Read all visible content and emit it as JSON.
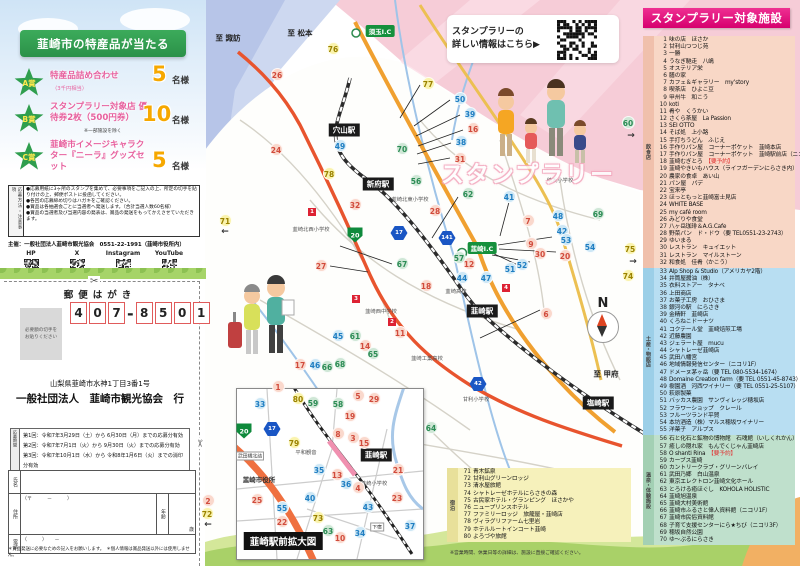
{
  "prize_panel": {
    "ribbon": "韮崎市の特産品が当たる",
    "prizes": [
      {
        "badge": "A賞",
        "title": "特産品詰め合わせ",
        "note": "（3千円相当）",
        "count": "5",
        "unit": "名様"
      },
      {
        "badge": "B賞",
        "title": "スタンプラリー対象店 優待券2枚（500円券）",
        "note": "※一部施設を除く",
        "count": "10",
        "unit": "名様"
      },
      {
        "badge": "C賞",
        "title": "韮崎市イメージキャラクター『ニーラ』グッズセット",
        "note": "",
        "count": "5",
        "unit": "名様"
      }
    ],
    "notes_label": "応募方法・注意事項",
    "notes": [
      "●応募用紙に3ヶ所のスタンプを集めて、必要事項をご記入の上、所定の切手を貼り付けの上、郵便ポストに投函してください。",
      "●各回の応募締め切りはハガキをご確認ください。",
      "●賞品は各抽選会ごとに当選者へ発送します。（合計当選人数60名様）",
      "●賞品の当選者及び当選内容の発表は、賞品の発送をもってかえさせていただきます。"
    ],
    "organizer": "主催：一般社団法人韮崎市観光協会　0551-22-1991（韮崎市役所内）",
    "sns": [
      "HP",
      "X",
      "Instagram",
      "YouTube"
    ]
  },
  "postcard": {
    "header": "郵便はがき",
    "postal_code": [
      "4",
      "0",
      "7",
      "8",
      "5",
      "0",
      "1"
    ],
    "stamp_note": "必要額の切手を\nお貼りください",
    "address": "山梨県韮崎市水神1丁目3番1号",
    "recipient": "一般社団法人　韮崎市観光協会　行",
    "rounds_label": "応募期間",
    "rounds": [
      "第1回：令和7年3月29日（土）から 6月30日（月）までの応募分有効",
      "第2回：令和7年7月1日（火）から 9月30日（火）までの応募分有効",
      "第3回：令和7年10月1日（水）から 令和8年1月6日（火）までの消印分有効"
    ],
    "form": {
      "name_label": "氏名",
      "address_label": "住所",
      "zip": "（〒　　　－　　　）",
      "age_label": "年齢",
      "age_unit": "歳",
      "tel_label": "電話",
      "tel_format": "（　　　）　　－"
    },
    "footnote": "＊賞品発送に必要なための記入をお願いします。　＊個人情報は賞品発送以外には使用しません。"
  },
  "map": {
    "info_banner_line1": "スタンプラリーの",
    "info_banner_line2": "詳しい情報はこちら▶",
    "deco_title": "スタンプラリー",
    "inset_title": "韮崎駅前拡大図",
    "compass": "N",
    "labels": [
      {
        "t": "至 諏訪",
        "x": 228,
        "y": 38,
        "k": "dir"
      },
      {
        "t": "至 松本",
        "x": 300,
        "y": 33,
        "k": "dir"
      },
      {
        "t": "至 甲府",
        "x": 606,
        "y": 374,
        "k": "dir"
      },
      {
        "t": "須玉I.C",
        "x": 380,
        "y": 31,
        "k": "ic"
      },
      {
        "t": "韮崎I.C",
        "x": 482,
        "y": 248,
        "k": "ic"
      },
      {
        "t": "穴山駅",
        "x": 344,
        "y": 130,
        "k": "station"
      },
      {
        "t": "新府駅",
        "x": 378,
        "y": 184,
        "k": "station"
      },
      {
        "t": "韮崎駅",
        "x": 482,
        "y": 311,
        "k": "station"
      },
      {
        "t": "塩崎駅",
        "x": 598,
        "y": 403,
        "k": "station"
      },
      {
        "t": "韮崎駅",
        "x": 376,
        "y": 455,
        "k": "station"
      },
      {
        "t": "穂坂小学校",
        "x": 560,
        "y": 180,
        "k": "school"
      },
      {
        "t": "韮崎北東小学校",
        "x": 410,
        "y": 199,
        "k": "school"
      },
      {
        "t": "韮崎北西小学校",
        "x": 311,
        "y": 229,
        "k": "school"
      },
      {
        "t": "韮崎西中学校",
        "x": 381,
        "y": 311,
        "k": "school"
      },
      {
        "t": "韮崎高校",
        "x": 456,
        "y": 291,
        "k": "school"
      },
      {
        "t": "韮崎工業高校",
        "x": 427,
        "y": 358,
        "k": "school"
      },
      {
        "t": "甘利小学校",
        "x": 476,
        "y": 399,
        "k": "school"
      },
      {
        "t": "韮崎小学校",
        "x": 374,
        "y": 483,
        "k": "school"
      },
      {
        "t": "平和観音",
        "x": 306,
        "y": 452,
        "k": "school"
      },
      {
        "t": "韮崎市役所",
        "x": 259,
        "y": 479,
        "k": "place"
      },
      {
        "t": "武田橋北詰",
        "x": 250,
        "y": 456,
        "k": "smallbox"
      },
      {
        "t": "下宿",
        "x": 377,
        "y": 527,
        "k": "smallbox"
      },
      {
        "t": "←",
        "x": 225,
        "y": 232,
        "k": "arrow"
      },
      {
        "t": "←",
        "x": 208,
        "y": 525,
        "k": "arrow"
      },
      {
        "t": "→",
        "x": 631,
        "y": 136,
        "k": "arrow"
      },
      {
        "t": "→",
        "x": 633,
        "y": 262,
        "k": "arrow"
      }
    ],
    "route_badges": [
      {
        "t": "141",
        "x": 447,
        "y": 238,
        "s": "hex"
      },
      {
        "t": "17",
        "x": 399,
        "y": 233,
        "s": "hex"
      },
      {
        "t": "42",
        "x": 478,
        "y": 384,
        "s": "hex"
      },
      {
        "t": "20",
        "x": 355,
        "y": 235,
        "s": "shield"
      },
      {
        "t": "20",
        "x": 244,
        "y": 431,
        "s": "shield"
      },
      {
        "t": "17",
        "x": 272,
        "y": 429,
        "s": "hex"
      }
    ],
    "spot_badges": [
      {
        "t": "1",
        "x": 312,
        "y": 212
      },
      {
        "t": "3",
        "x": 356,
        "y": 299
      },
      {
        "t": "2",
        "x": 392,
        "y": 322
      },
      {
        "t": "4",
        "x": 506,
        "y": 288
      }
    ],
    "markers": [
      [
        1,
        278,
        386,
        "f"
      ],
      [
        2,
        208,
        500,
        "f"
      ],
      [
        3,
        353,
        437,
        "f"
      ],
      [
        4,
        358,
        487,
        "f"
      ],
      [
        5,
        358,
        395,
        "f"
      ],
      [
        6,
        546,
        313,
        "f"
      ],
      [
        7,
        528,
        220,
        "f"
      ],
      [
        8,
        338,
        433,
        "f"
      ],
      [
        9,
        531,
        243,
        "f"
      ],
      [
        10,
        340,
        537,
        "f"
      ],
      [
        11,
        400,
        332,
        "f"
      ],
      [
        12,
        469,
        263,
        "f"
      ],
      [
        13,
        337,
        474,
        "f"
      ],
      [
        14,
        365,
        345,
        "f"
      ],
      [
        15,
        364,
        442,
        "f"
      ],
      [
        16,
        473,
        128,
        "f"
      ],
      [
        17,
        300,
        364,
        "f"
      ],
      [
        18,
        426,
        285,
        "f"
      ],
      [
        19,
        350,
        415,
        "f"
      ],
      [
        20,
        565,
        255,
        "f"
      ],
      [
        21,
        398,
        469,
        "f"
      ],
      [
        22,
        282,
        521,
        "f"
      ],
      [
        23,
        397,
        497,
        "f"
      ],
      [
        24,
        276,
        149,
        "f"
      ],
      [
        25,
        257,
        499,
        "f"
      ],
      [
        26,
        277,
        74,
        "f"
      ],
      [
        27,
        321,
        265,
        "f"
      ],
      [
        28,
        435,
        210,
        "f"
      ],
      [
        29,
        374,
        398,
        "f"
      ],
      [
        30,
        540,
        253,
        "f"
      ],
      [
        31,
        460,
        158,
        "f"
      ],
      [
        32,
        355,
        204,
        "f"
      ],
      [
        33,
        260,
        403,
        "s"
      ],
      [
        34,
        360,
        532,
        "s"
      ],
      [
        35,
        319,
        469,
        "s"
      ],
      [
        36,
        346,
        483,
        "s"
      ],
      [
        37,
        410,
        525,
        "s"
      ],
      [
        38,
        461,
        141,
        "s"
      ],
      [
        39,
        470,
        113,
        "s"
      ],
      [
        40,
        310,
        497,
        "s"
      ],
      [
        41,
        509,
        196,
        "s"
      ],
      [
        42,
        562,
        230,
        "s"
      ],
      [
        43,
        368,
        506,
        "s"
      ],
      [
        44,
        462,
        277,
        "s"
      ],
      [
        45,
        338,
        335,
        "s"
      ],
      [
        46,
        315,
        364,
        "s"
      ],
      [
        47,
        486,
        277,
        "s"
      ],
      [
        48,
        558,
        215,
        "s"
      ],
      [
        49,
        340,
        145,
        "s"
      ],
      [
        50,
        460,
        98,
        "s"
      ],
      [
        51,
        510,
        268,
        "s"
      ],
      [
        52,
        522,
        264,
        "s"
      ],
      [
        53,
        566,
        239,
        "s"
      ],
      [
        54,
        590,
        246,
        "s"
      ],
      [
        55,
        282,
        507,
        "s"
      ],
      [
        56,
        416,
        180,
        "g"
      ],
      [
        57,
        459,
        257,
        "g"
      ],
      [
        58,
        338,
        403,
        "g"
      ],
      [
        59,
        313,
        402,
        "g"
      ],
      [
        60,
        628,
        122,
        "g"
      ],
      [
        61,
        355,
        335,
        "g"
      ],
      [
        62,
        468,
        193,
        "g"
      ],
      [
        63,
        328,
        530,
        "g"
      ],
      [
        64,
        431,
        427,
        "g"
      ],
      [
        65,
        373,
        353,
        "g"
      ],
      [
        66,
        327,
        366,
        "g"
      ],
      [
        67,
        402,
        263,
        "g"
      ],
      [
        68,
        340,
        363,
        "g"
      ],
      [
        69,
        598,
        213,
        "g"
      ],
      [
        70,
        402,
        148,
        "g"
      ],
      [
        71,
        225,
        220,
        "y"
      ],
      [
        72,
        207,
        513,
        "y"
      ],
      [
        73,
        318,
        517,
        "y"
      ],
      [
        74,
        628,
        275,
        "y"
      ],
      [
        75,
        630,
        248,
        "y"
      ],
      [
        76,
        333,
        48,
        "y"
      ],
      [
        77,
        428,
        83,
        "y"
      ],
      [
        78,
        329,
        173,
        "y"
      ],
      [
        79,
        294,
        442,
        "y"
      ],
      [
        80,
        298,
        398,
        "y"
      ]
    ]
  },
  "facility_list": {
    "header": "スタンプラリー対象施設",
    "sections": [
      {
        "label": "飲食店",
        "bg": "#f8d7c6",
        "strip": "#f0c0ac",
        "start": 1,
        "items": [
          "味の店　ほさか",
          "甘利山つつじ苑",
          "一勝",
          "うなぎ馳走　八嶋",
          "オステリア栄",
          "膳の家",
          "カフェ＆ギャラリー　my’story",
          "喫茶店　ひよこ豆",
          "甲州牛　和こう",
          "koti",
          "肴や　くうかい",
          "さくら茶屋　La Passion",
          "SEI OTTO",
          "そば処　上小路",
          "手打ちうどん　ふじえ",
          "手作りパン屋　コーナーポケット　韮崎本店",
          "手作りパン屋　コーナーポケット　韮崎駅前店（ニコリ1F）",
          "韮崎むぎとろ　【要予約】",
          "韮崎やきいもハウス（ライフガーデンにらさき内）",
          "農家の食卓　あい山",
          "パン屋　パデ",
          "宝来亭",
          "ほっともっと韮崎富士見店",
          "WHITE BASE",
          "my café room",
          "みどりや食堂",
          "八ヶ岳珈琲＆A.G.Cafe",
          "野菜パン　ド・ドウ（要 TEL0551-23-2743）",
          "ゆいまる",
          "レストラン　キュイエット",
          "レストラン　マイルストーン",
          "和食処　佳肴（かこう）"
        ]
      },
      {
        "label": "土産・物販店",
        "bg": "#b8def2",
        "strip": "#9ccfe8",
        "start": 33,
        "items": [
          "Alp Shop & Studio（アメリカヤ2階）",
          "井筒屋醤油（株）",
          "衣料ストアー　タナベ",
          "上田商店",
          "お菓子工房　おひさま",
          "銀河の駅　にらさき",
          "金精軒　韮崎店",
          "くろねこドーナツ",
          "コクテール堂　韮崎焙煎工場",
          "近藤農園",
          "ジェラート屋　mucu",
          "シャトレーゼ韮崎店",
          "武田八幡宮",
          "地域情報発信センター（ニコリ1F）",
          "ドメーヌ茅ヶ岳（要 TEL 080-5534-1674）",
          "Domaine Creation farm（要 TEL 0551-45-8743）",
          "樹園酒　河西ワイナリー（要 TEL 0551-25-5107）",
          "萩原製菓",
          "バッカス農園　サンヴィレッジ穂坂店",
          "フラワーショップ　クレール",
          "フルーツランド平賀",
          "本坊酒造（株）マルス穂坂ワイナリー",
          "洋菓子　アルプス"
        ]
      },
      {
        "label": "温泉・体験施設",
        "bg": "#bfe0cc",
        "strip": "#a3d0b4",
        "start": 56,
        "items": [
          "石と化石と鉱物の博物館　石魂館（いしくれかん）",
          "癒しの隠れ家　もんでくじゃん韮崎店",
          "O shanti Rina　【要予約】",
          "カーブス韮崎",
          "カントリークラブ・グリーンバレイ",
          "武田乃郷　白山温泉",
          "東京エレクトロン韮崎文化ホール",
          "とろける癒ほぐし　KOHOLA HOLISTIC",
          "韮崎旭温泉",
          "韮崎大村美術館",
          "韮崎市ふるさと偉人資料館（ニコリ1F）",
          "韮崎市民俗資料館",
          "子育て支援センターにら★ちび（ニコリ3F）",
          "穂坂自然公園",
          "ゆ〜ぷるにらさき"
        ]
      },
      {
        "label": "宿泊",
        "bg": "#f6f1bb",
        "strip": "#e8e09a",
        "start": 71,
        "items": [
          "青木鉱泉",
          "甘利山グリーンロッジ",
          "清水屋旅館",
          "シャトレーゼホテルにらさきの森",
          "古民家ホテル・グランピング　ほさかや",
          "ニュープリンスホテル",
          "ファミリーロッジ　旅籠屋・韮崎店",
          "ヴィラグリファーム七里岩",
          "ホテルルートインコート韮崎",
          "よろづや旅館"
        ]
      }
    ],
    "footnote": "※営業時間、休業日等の詳細は、施設に直接ご確認ください。"
  }
}
